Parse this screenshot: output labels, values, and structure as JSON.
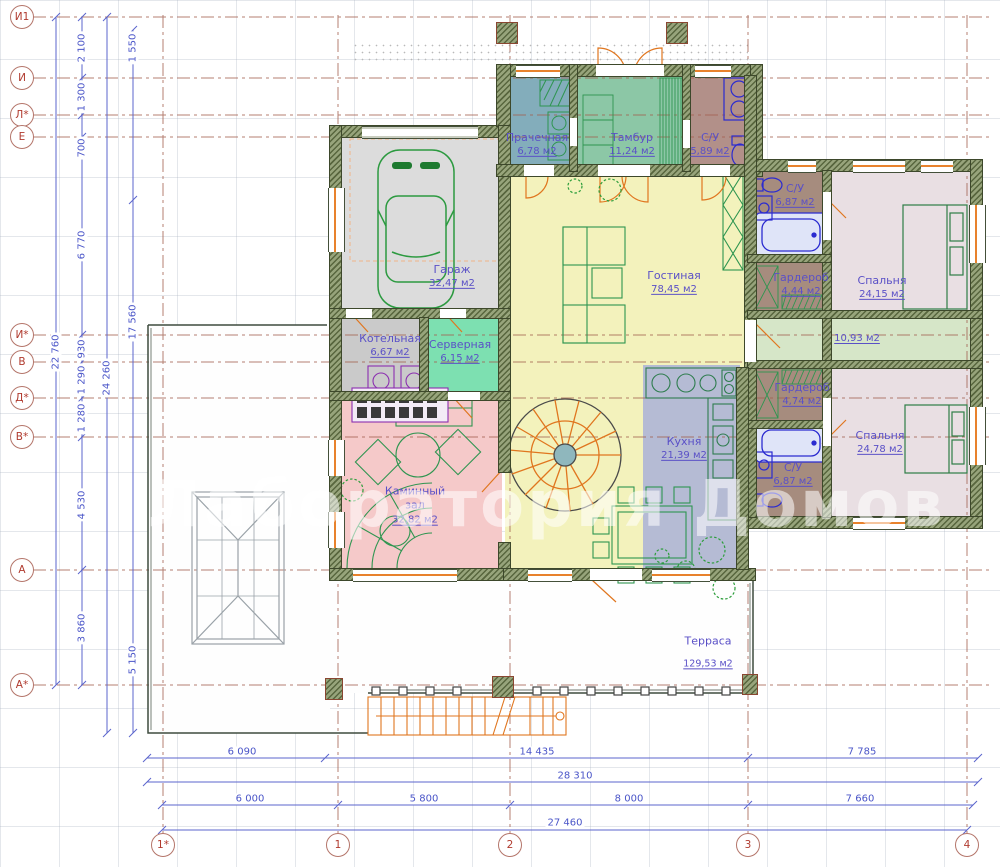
{
  "plan": {
    "watermark": "Лаборатория Домов"
  },
  "axes": {
    "left": [
      "И1",
      "И",
      "Л*",
      "Е",
      "И*",
      "В",
      "Д*",
      "В*",
      "А",
      "А*"
    ],
    "bottom": [
      "1*",
      "1",
      "2",
      "3",
      "4"
    ]
  },
  "dims": {
    "left": [
      "2 100",
      "1 550",
      "1 300",
      "700",
      "6 770",
      "17 560",
      "22 760",
      "930",
      "24 260",
      "1 290",
      "1 280",
      "4 530",
      "3 860",
      "5 150"
    ],
    "bottom": [
      "6 090",
      "14 435",
      "7 785",
      "28 310",
      "6 000",
      "5 800",
      "8 000",
      "7 660",
      "27 460"
    ]
  },
  "rooms": [
    {
      "name": "Гараж",
      "area": "32,47 м2"
    },
    {
      "name": "Прачечная",
      "area": "6,78 м2"
    },
    {
      "name": "Тамбур",
      "area": "11,24 м2"
    },
    {
      "name": "С/У",
      "area": "5,89 м2"
    },
    {
      "name": "Гостиная",
      "area": "78,45 м2"
    },
    {
      "name": "С/У",
      "area": "6,87 м2"
    },
    {
      "name": "Гардероб",
      "area": "4,44 м2"
    },
    {
      "name": "Спальня",
      "area": "24,15 м2"
    },
    {
      "name": "",
      "area": "10,93 м2"
    },
    {
      "name": "Гардероб",
      "area": "4,74 м2"
    },
    {
      "name": "С/У",
      "area": "6,87 м2"
    },
    {
      "name": "Спальня",
      "area": "24,78 м2"
    },
    {
      "name": "Котельная",
      "area": "6,67 м2"
    },
    {
      "name": "Серверная",
      "area": "6,15 м2"
    },
    {
      "name": "Кухня",
      "area": "21,39 м2"
    },
    {
      "name": "Каминный\nзал",
      "area": "32,82 м2"
    },
    {
      "name": "Терраса",
      "area": "129,53 м2"
    }
  ],
  "colors": {
    "wall_green": "#58663e",
    "accent_orange": "#e0761f",
    "label_purple": "#5a50c7",
    "dim_blue": "#4a55c8",
    "axis_red": "#b03a2e",
    "living_yellow": "#f3f2bc",
    "fireplace_pink": "#f5c9c9",
    "kitchen_blue": "#b5bbd4",
    "bedroom_lilac": "#e9dfe3",
    "tambour_green": "#8cc7a6",
    "server_mint": "#7de0b1",
    "hall_green": "#d6e6c8",
    "bath_brown": "#a68c7e",
    "laundry_blue": "#83adbb",
    "garage_gray": "#dcdcdc"
  }
}
